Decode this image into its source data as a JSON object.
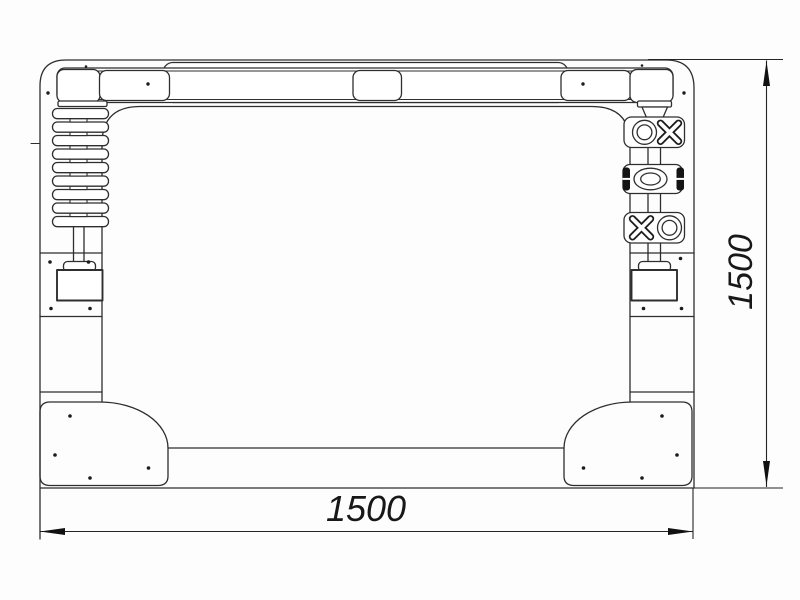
{
  "drawing": {
    "dimension_width": {
      "value": "1500",
      "orientation": "horizontal",
      "position": "bottom"
    },
    "dimension_height": {
      "value": "1500",
      "orientation": "vertical",
      "position": "right"
    },
    "colors": {
      "line": "#2e2e2e",
      "dimension_text": "#181818",
      "clamp_fill": "#141414",
      "background": "#ffffff"
    },
    "marks": {
      "top_block": [
        "circle-mark",
        "cross-mark"
      ],
      "middle_block": [
        "ellipse-mark"
      ],
      "bottom_block": [
        "cross-mark",
        "circle-mark"
      ]
    },
    "spring_slat_count": 9
  }
}
